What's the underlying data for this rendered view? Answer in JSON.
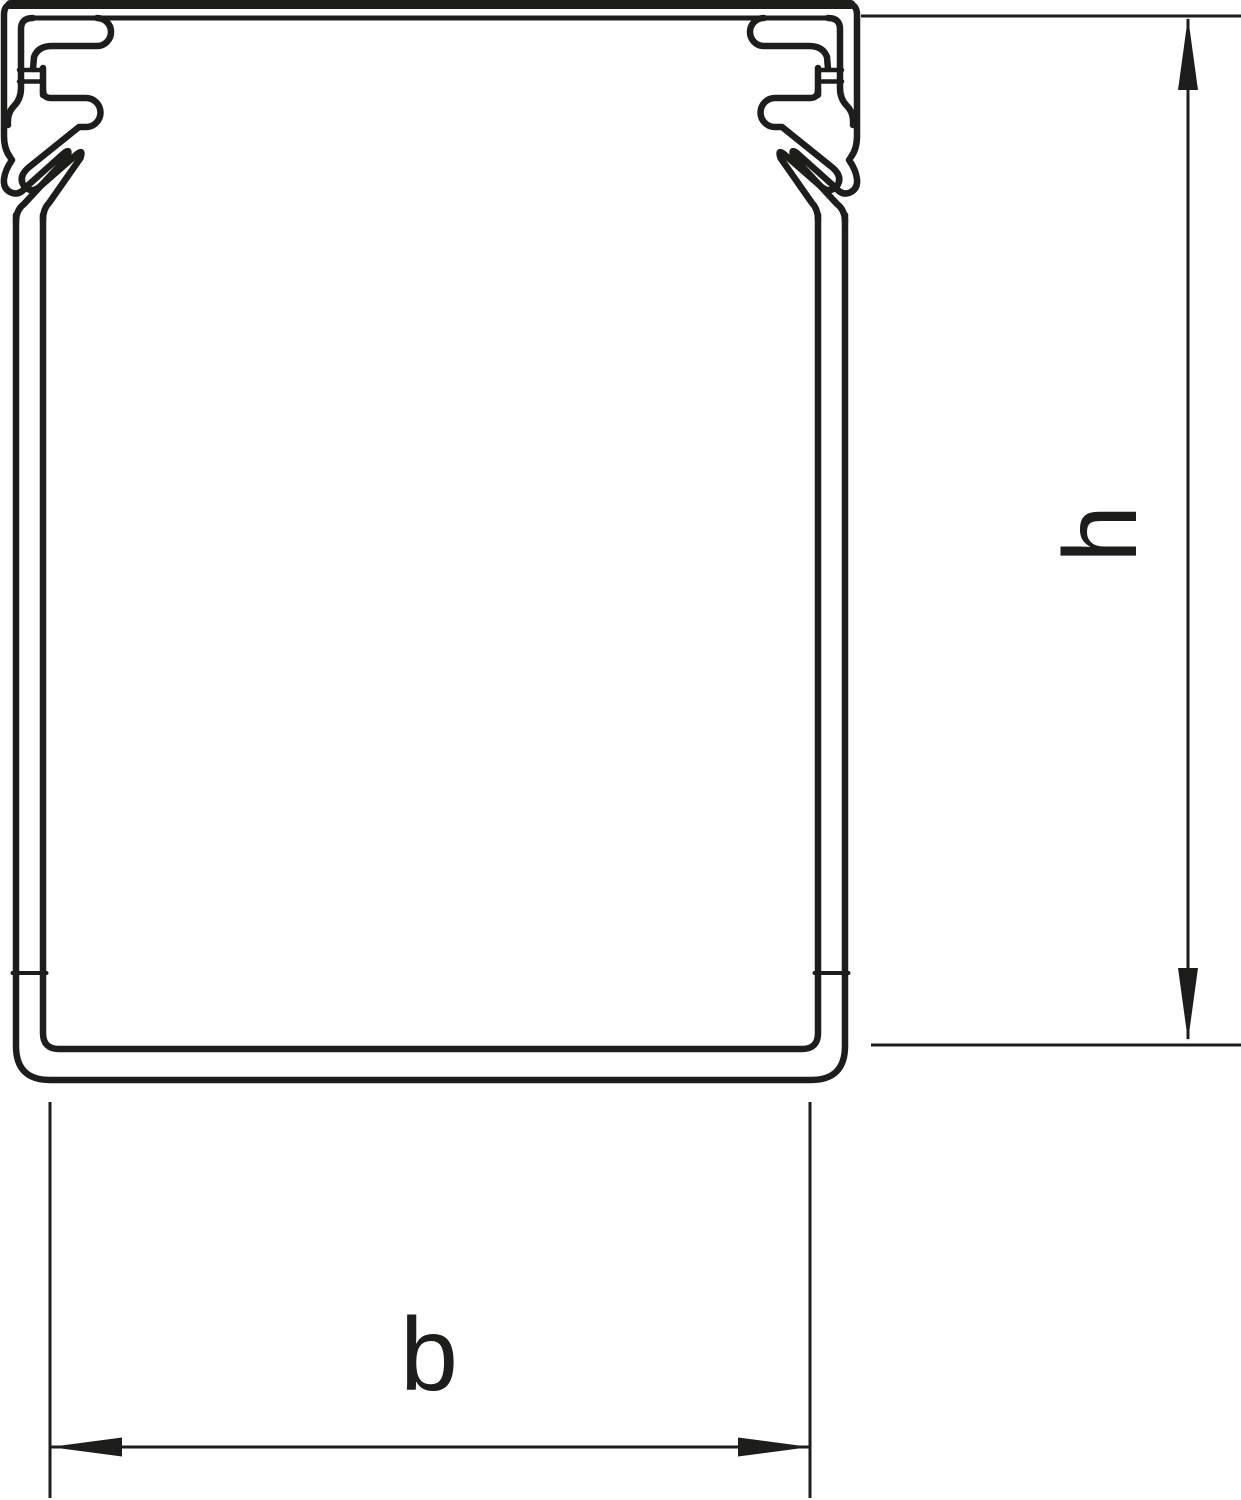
{
  "drawing": {
    "stroke_color": "#1d1d1b",
    "background_color": "#ffffff",
    "dimension_labels": {
      "height": "h",
      "width": "b"
    }
  }
}
